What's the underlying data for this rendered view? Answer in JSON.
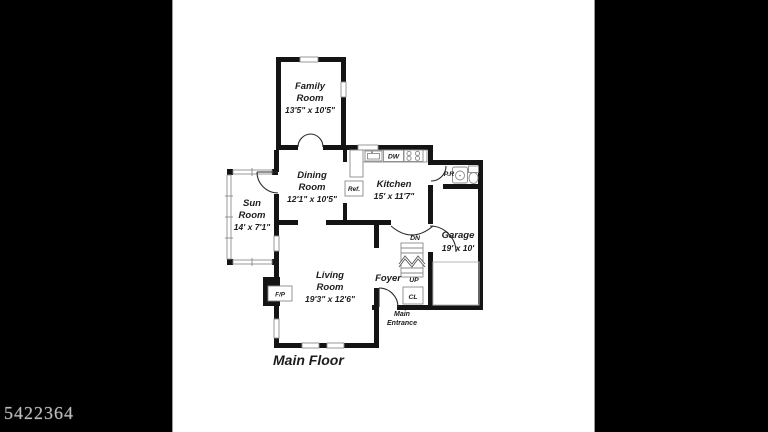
{
  "watermark": "5422364",
  "floor_title": "Main Floor",
  "rooms": {
    "family": {
      "lines": [
        "Family",
        "Room",
        "13'5\" x 10'5\""
      ]
    },
    "dining": {
      "lines": [
        "Dining",
        "Room",
        "12'1\" x 10'5\""
      ]
    },
    "kitchen": {
      "lines": [
        "Kitchen",
        "15' x 11'7\""
      ]
    },
    "sun": {
      "lines": [
        "Sun",
        "Room",
        "14' x 7'1\""
      ]
    },
    "living": {
      "lines": [
        "Living",
        "Room",
        "19'3\" x 12'6\""
      ]
    },
    "garage": {
      "lines": [
        "Garage",
        "19' x 10'"
      ]
    },
    "foyer": {
      "label": "Foyer"
    }
  },
  "fixtures": {
    "dishwasher": "DW",
    "refrigerator": "Ref.",
    "powder_room": "P.R",
    "stairs_down": "DN",
    "stairs_up": "UP",
    "closet": "CL",
    "fireplace": "F/P",
    "entrance_line1": "Main",
    "entrance_line2": "Entrance"
  },
  "colors": {
    "matte": "#000000",
    "paper": "#ffffff",
    "wall": "#141414",
    "fixture_line": "#8a8a8a",
    "text": "#1c1c1c",
    "watermark": "#bdbdbd"
  }
}
